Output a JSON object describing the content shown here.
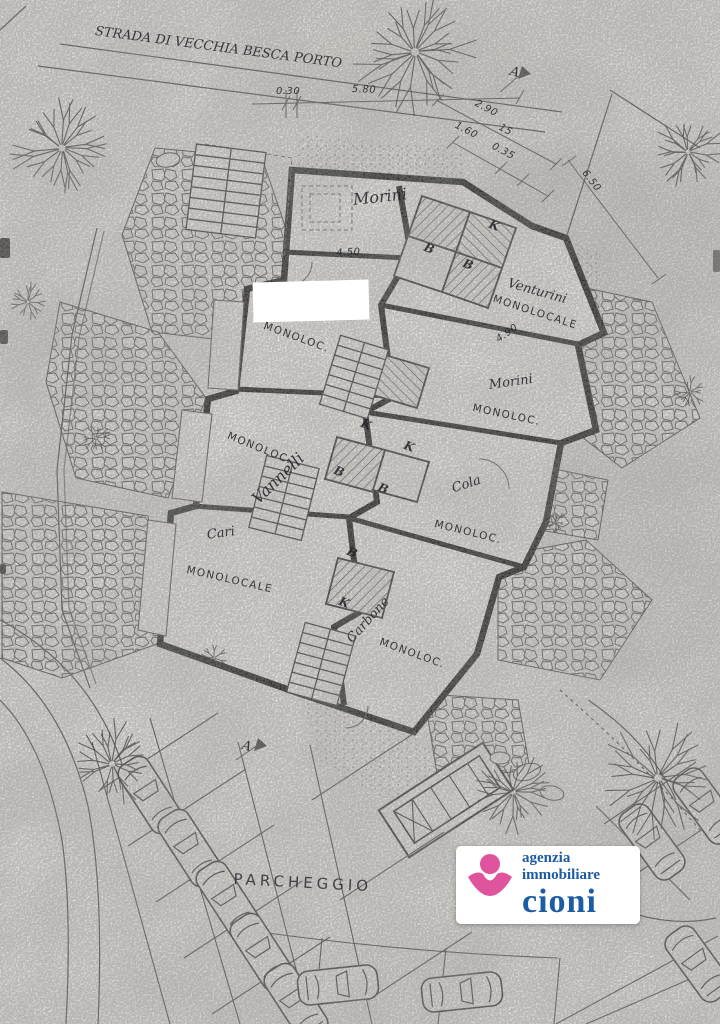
{
  "plan": {
    "street_label": "STRADA DI VECCHIA BESCA PORTO",
    "parking_label": "PARCHEGGIO",
    "section_marker": "A",
    "room_code_bath": "B",
    "room_code_kitchen": "K",
    "owner_names": [
      "Morini",
      "Venturini",
      "Vannelli",
      "Cola",
      "Cari",
      "Carbone"
    ],
    "unit_type_labels": [
      "MONOLOC.",
      "MONOLOCALE"
    ],
    "dimension_values": [
      "0.30",
      "5.80",
      "2.90",
      "1.60",
      "15",
      "0.35",
      "6.50",
      "4.50",
      "4.90"
    ],
    "labels": [
      {
        "name": "label-street",
        "text": "STRADA DI VECCHIA BESCA PORTO",
        "x": 96,
        "y": 24,
        "rot": 7.5,
        "cls": "hw-sm"
      },
      {
        "name": "label-dim-030",
        "text": "0.30",
        "x": 276,
        "y": 86,
        "rot": 0,
        "cls": "dim"
      },
      {
        "name": "label-dim-580",
        "text": "5.80",
        "x": 352,
        "y": 84,
        "rot": 2,
        "cls": "dim"
      },
      {
        "name": "label-dim-290",
        "text": "2.90",
        "x": 478,
        "y": 98,
        "rot": 28,
        "cls": "dim"
      },
      {
        "name": "label-dim-160",
        "text": "1.60",
        "x": 458,
        "y": 120,
        "rot": 28,
        "cls": "dim"
      },
      {
        "name": "label-dim-15",
        "text": "15",
        "x": 502,
        "y": 122,
        "rot": 28,
        "cls": "dim"
      },
      {
        "name": "label-dim-035",
        "text": "0.35",
        "x": 495,
        "y": 141,
        "rot": 28,
        "cls": "dim"
      },
      {
        "name": "label-dim-650",
        "text": "6.50",
        "x": 588,
        "y": 168,
        "rot": 52,
        "cls": "dim"
      },
      {
        "name": "label-section-a-top",
        "text": "A",
        "x": 512,
        "y": 64,
        "rot": 15,
        "cls": "hw-sm"
      },
      {
        "name": "label-owner-morini-1",
        "text": "Morini",
        "x": 352,
        "y": 190,
        "rot": -6,
        "cls": "hw"
      },
      {
        "name": "label-dim-450",
        "text": "4.50",
        "x": 336,
        "y": 248,
        "rot": -3,
        "cls": "dim"
      },
      {
        "name": "label-owner-venturini",
        "text": "Venturini",
        "x": 510,
        "y": 276,
        "rot": 16,
        "cls": "hw-sm"
      },
      {
        "name": "label-unit-venturini",
        "text": "MONOLOCALE",
        "x": 495,
        "y": 293,
        "rot": 18,
        "cls": "print"
      },
      {
        "name": "label-dim-490",
        "text": "4.90",
        "x": 494,
        "y": 336,
        "rot": -35,
        "cls": "dim"
      },
      {
        "name": "label-unit-2",
        "text": "MONOLOC.",
        "x": 266,
        "y": 320,
        "rot": 20,
        "cls": "print"
      },
      {
        "name": "label-owner-morini-2",
        "text": "Morini",
        "x": 488,
        "y": 378,
        "rot": -8,
        "cls": "hw-sm"
      },
      {
        "name": "label-unit-morini-2",
        "text": "MONOLOC.",
        "x": 474,
        "y": 402,
        "rot": 12,
        "cls": "print"
      },
      {
        "name": "label-unit-3",
        "text": "MONOLOC.",
        "x": 230,
        "y": 430,
        "rot": 22,
        "cls": "print"
      },
      {
        "name": "label-owner-vannelli",
        "text": "Vannelli",
        "x": 248,
        "y": 494,
        "rot": -44,
        "cls": "hw"
      },
      {
        "name": "label-owner-cola",
        "text": "Cola",
        "x": 450,
        "y": 482,
        "rot": -18,
        "cls": "hw-sm"
      },
      {
        "name": "label-unit-cola",
        "text": "MONOLOC.",
        "x": 436,
        "y": 518,
        "rot": 14,
        "cls": "print"
      },
      {
        "name": "label-owner-cari",
        "text": "Cari",
        "x": 206,
        "y": 528,
        "rot": -8,
        "cls": "hw-sm"
      },
      {
        "name": "label-unit-4",
        "text": "MONOLOCALE",
        "x": 188,
        "y": 564,
        "rot": 13,
        "cls": "print"
      },
      {
        "name": "label-owner-carbone",
        "text": "Carbone",
        "x": 344,
        "y": 636,
        "rot": -48,
        "cls": "hw-sm"
      },
      {
        "name": "label-unit-carbone",
        "text": "MONOLOC.",
        "x": 382,
        "y": 636,
        "rot": 20,
        "cls": "print"
      },
      {
        "name": "label-parcheggio",
        "text": "PARCHEGGIO",
        "x": 234,
        "y": 870,
        "rot": 3,
        "cls": "print-lg"
      },
      {
        "name": "label-room-b-1",
        "text": "B",
        "x": 427,
        "y": 240,
        "rot": 22,
        "cls": "rm"
      },
      {
        "name": "label-room-b-2",
        "text": "B",
        "x": 466,
        "y": 256,
        "rot": 22,
        "cls": "rm"
      },
      {
        "name": "label-room-b-3",
        "text": "B",
        "x": 337,
        "y": 463,
        "rot": 22,
        "cls": "rm"
      },
      {
        "name": "label-room-b-4",
        "text": "B",
        "x": 381,
        "y": 480,
        "rot": 22,
        "cls": "rm"
      },
      {
        "name": "label-room-b-5",
        "text": "B",
        "x": 350,
        "y": 544,
        "rot": 22,
        "cls": "rm"
      },
      {
        "name": "label-room-k-1",
        "text": "K",
        "x": 492,
        "y": 217,
        "rot": 22,
        "cls": "rm"
      },
      {
        "name": "label-room-k-2",
        "text": "K",
        "x": 364,
        "y": 416,
        "rot": 22,
        "cls": "rm"
      },
      {
        "name": "label-room-k-3",
        "text": "K",
        "x": 407,
        "y": 438,
        "rot": 22,
        "cls": "rm"
      },
      {
        "name": "label-room-k-4",
        "text": "K",
        "x": 342,
        "y": 594,
        "rot": 22,
        "cls": "rm"
      },
      {
        "name": "label-section-a-bottom",
        "text": "A",
        "x": 244,
        "y": 738,
        "rot": 15,
        "cls": "hw-sm"
      }
    ]
  },
  "logo": {
    "line1": "agenzia",
    "line2": "immobiliare",
    "line3": "cioni",
    "pink": "#df549c",
    "blue": "#1d5ba3"
  }
}
